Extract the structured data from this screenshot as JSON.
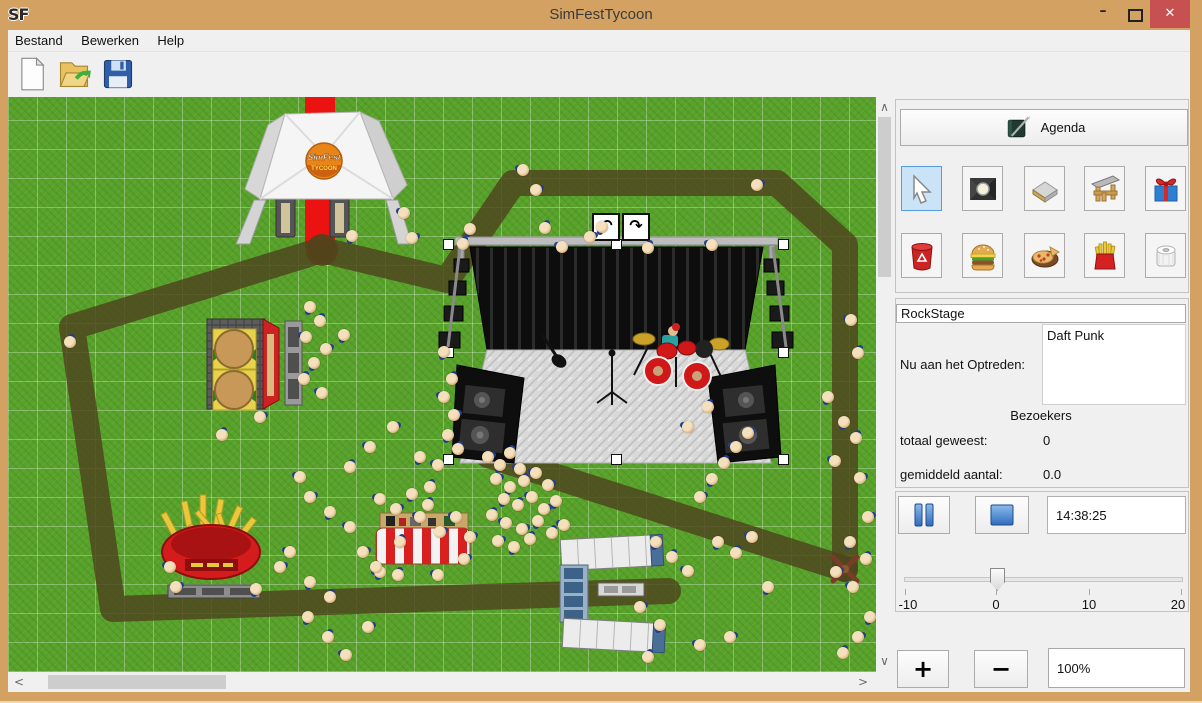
{
  "window": {
    "logo": "SF",
    "title": "SimFestTycoon",
    "minimize": "–",
    "maximize": "maximize-icon",
    "close": "✕"
  },
  "menu": {
    "items": [
      "Bestand",
      "Bewerken",
      "Help"
    ]
  },
  "toolbar": {
    "icons": [
      "new-document-icon",
      "open-file-icon",
      "save-file-icon"
    ]
  },
  "scrollbars": {
    "up": "∧",
    "down": "∨",
    "left": "<",
    "right": ">"
  },
  "panel": {
    "agenda": {
      "label": "Agenda",
      "icon": "agenda-book-icon"
    },
    "tools": {
      "selected": "select-cursor",
      "row1": [
        "select-cursor",
        "stage-spotlight",
        "path-tile",
        "stage-structure",
        "gift"
      ],
      "row2": [
        "trash-can",
        "burger",
        "pizza",
        "fries",
        "toilet-paper"
      ]
    },
    "stage_info": {
      "name": "RockStage",
      "now_label": "Nu aan het Optreden:",
      "now_value": "Daft Punk",
      "visitors_heading": "Bezoekers",
      "total_label": "totaal geweest:",
      "total_value": "0",
      "avg_label": "gemiddeld aantal:",
      "avg_value": "0.0"
    },
    "playback": {
      "pause_icon": "pause-icon",
      "stop_icon": "stop-icon",
      "time": "14:38:25"
    },
    "speed_slider": {
      "min": -10,
      "max": 20,
      "value": 0,
      "tick_labels": [
        "-10",
        "0",
        "10",
        "20"
      ]
    },
    "zoom": {
      "in": "+",
      "out": "−",
      "level": "100%"
    }
  },
  "canvas": {
    "tent_logo_line1": "SimFest",
    "tent_logo_line2": "TYCOON",
    "rotate_left": "↶",
    "rotate_right": "↷",
    "grass_color": "#58a22c",
    "path_color": "#4e431d",
    "carpet_color": "#ec1212",
    "carpet": {
      "x": 297,
      "y": 0,
      "w": 30,
      "h": 150
    },
    "paths": [
      [
        [
          314,
          153
        ],
        [
          64,
          230
        ],
        [
          105,
          512
        ],
        [
          660,
          494
        ]
      ],
      [
        [
          314,
          153
        ],
        [
          439,
          183
        ],
        [
          505,
          86
        ],
        [
          769,
          86
        ],
        [
          837,
          148
        ],
        [
          837,
          472
        ]
      ],
      [
        [
          837,
          472
        ],
        [
          480,
          358
        ]
      ]
    ],
    "junctions": [
      [
        314,
        153
      ]
    ],
    "cross_marker": [
      837,
      472
    ],
    "selection": {
      "x1": 440,
      "y1": 147,
      "x2": 775,
      "y2": 362
    },
    "people": [
      [
        396,
        116
      ],
      [
        404,
        141
      ],
      [
        344,
        139
      ],
      [
        455,
        147
      ],
      [
        515,
        73
      ],
      [
        528,
        93
      ],
      [
        462,
        132
      ],
      [
        537,
        131
      ],
      [
        554,
        150
      ],
      [
        582,
        140
      ],
      [
        594,
        130
      ],
      [
        640,
        151
      ],
      [
        704,
        148
      ],
      [
        749,
        88
      ],
      [
        836,
        325
      ],
      [
        848,
        341
      ],
      [
        827,
        364
      ],
      [
        852,
        381
      ],
      [
        820,
        300
      ],
      [
        850,
        256
      ],
      [
        843,
        223
      ],
      [
        860,
        420
      ],
      [
        842,
        445
      ],
      [
        858,
        462
      ],
      [
        845,
        490
      ],
      [
        828,
        475
      ],
      [
        436,
        255
      ],
      [
        444,
        282
      ],
      [
        436,
        300
      ],
      [
        446,
        318
      ],
      [
        440,
        338
      ],
      [
        450,
        352
      ],
      [
        430,
        368
      ],
      [
        480,
        360
      ],
      [
        492,
        368
      ],
      [
        502,
        356
      ],
      [
        512,
        372
      ],
      [
        488,
        382
      ],
      [
        502,
        390
      ],
      [
        516,
        384
      ],
      [
        528,
        376
      ],
      [
        540,
        388
      ],
      [
        496,
        402
      ],
      [
        510,
        408
      ],
      [
        524,
        400
      ],
      [
        536,
        412
      ],
      [
        548,
        404
      ],
      [
        484,
        418
      ],
      [
        498,
        426
      ],
      [
        514,
        432
      ],
      [
        530,
        424
      ],
      [
        544,
        436
      ],
      [
        556,
        428
      ],
      [
        490,
        444
      ],
      [
        506,
        450
      ],
      [
        522,
        442
      ],
      [
        292,
        380
      ],
      [
        302,
        400
      ],
      [
        322,
        415
      ],
      [
        342,
        370
      ],
      [
        362,
        350
      ],
      [
        385,
        330
      ],
      [
        412,
        360
      ],
      [
        422,
        390
      ],
      [
        282,
        455
      ],
      [
        272,
        470
      ],
      [
        302,
        485
      ],
      [
        322,
        500
      ],
      [
        342,
        430
      ],
      [
        355,
        455
      ],
      [
        372,
        475
      ],
      [
        392,
        445
      ],
      [
        412,
        420
      ],
      [
        432,
        435
      ],
      [
        300,
        520
      ],
      [
        320,
        540
      ],
      [
        338,
        558
      ],
      [
        360,
        530
      ],
      [
        302,
        210
      ],
      [
        312,
        224
      ],
      [
        298,
        240
      ],
      [
        318,
        252
      ],
      [
        306,
        266
      ],
      [
        296,
        282
      ],
      [
        314,
        296
      ],
      [
        252,
        320
      ],
      [
        336,
        238
      ],
      [
        214,
        338
      ],
      [
        162,
        470
      ],
      [
        168,
        490
      ],
      [
        248,
        492
      ],
      [
        62,
        245
      ],
      [
        372,
        402
      ],
      [
        388,
        412
      ],
      [
        404,
        397
      ],
      [
        420,
        408
      ],
      [
        448,
        420
      ],
      [
        462,
        440
      ],
      [
        368,
        470
      ],
      [
        390,
        478
      ],
      [
        430,
        478
      ],
      [
        456,
        462
      ],
      [
        648,
        445
      ],
      [
        664,
        460
      ],
      [
        680,
        474
      ],
      [
        692,
        400
      ],
      [
        704,
        382
      ],
      [
        716,
        366
      ],
      [
        728,
        350
      ],
      [
        740,
        336
      ],
      [
        710,
        445
      ],
      [
        728,
        456
      ],
      [
        744,
        440
      ],
      [
        632,
        510
      ],
      [
        652,
        528
      ],
      [
        640,
        560
      ],
      [
        692,
        548
      ],
      [
        722,
        540
      ],
      [
        760,
        490
      ],
      [
        700,
        310
      ],
      [
        680,
        330
      ],
      [
        850,
        540
      ],
      [
        862,
        520
      ],
      [
        835,
        556
      ]
    ]
  }
}
